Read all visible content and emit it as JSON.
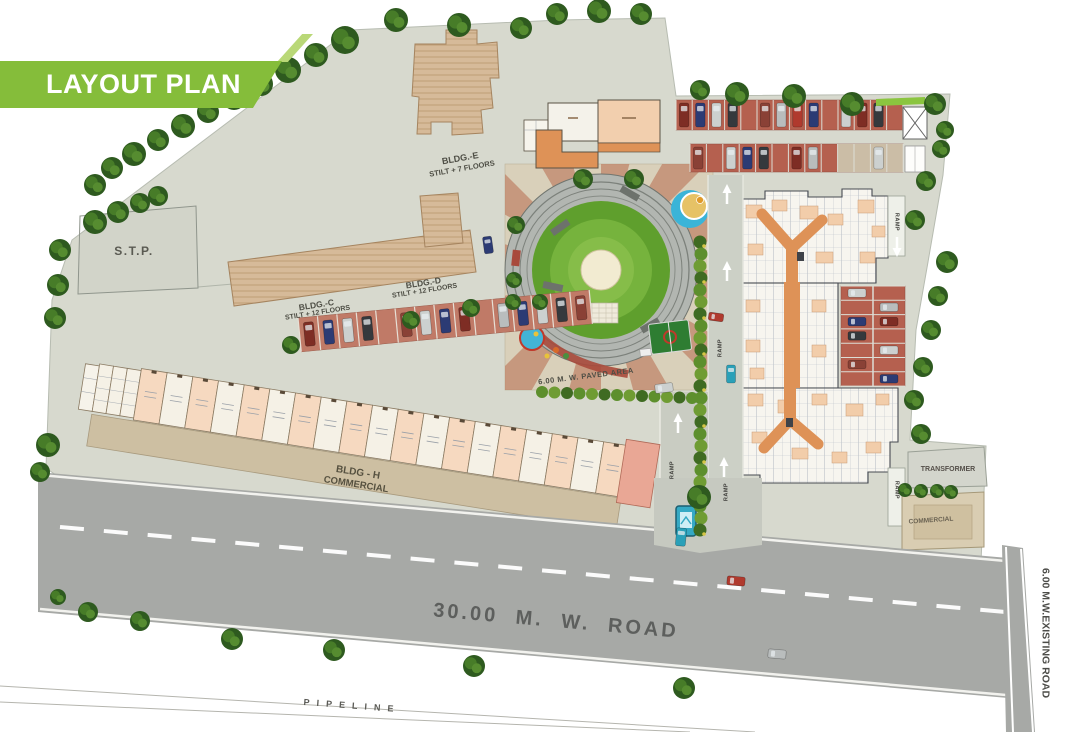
{
  "banner": {
    "title": "LAYOUT PLAN"
  },
  "plan": {
    "stp": "S.T.P.",
    "bldg_e_name": "BLDG.-E",
    "bldg_e_floors": "STILT + 7 FLOORS",
    "bldg_c_name": "BLDG.-C",
    "bldg_c_floors": "STILT + 12 FLOORS",
    "bldg_d_name": "BLDG.-D",
    "bldg_d_floors": "STILT + 12 FLOORS",
    "bldg_h_name": "BLDG - H",
    "bldg_h_type": "COMMERCIAL",
    "paved_area": "6.00 M. W. PAVED AREA",
    "transformer": "TRANSFORMER",
    "commercial_right": "COMMERCIAL",
    "ramp": "RAMP",
    "main_road": "30.00  M. W. ROAD",
    "existing_road": "6.00 M.W.EXISTING ROAD",
    "pipeline": "PIPELINE"
  },
  "icons": [
    "tree-icon",
    "car-icon",
    "arrow-up-icon",
    "gate-cabin-icon",
    "pool-icon",
    "basketball-court-icon",
    "cricket-ground-icon",
    "hedge-icon",
    "hatched-box-icon"
  ],
  "colors": {
    "banner_green": "#85bd3a",
    "banner_tail_green": "#b9d877",
    "paving": "#d7d9ce",
    "building_tan": "#d6ba99",
    "stall_red": "#b5604f",
    "road_gray": "#a7a9a6",
    "lawn_green": "#5f9f2d",
    "corridor_orange": "#de9257",
    "pool_blue": "#3ab3d8",
    "commercial_peach": "#f6d9c0"
  }
}
